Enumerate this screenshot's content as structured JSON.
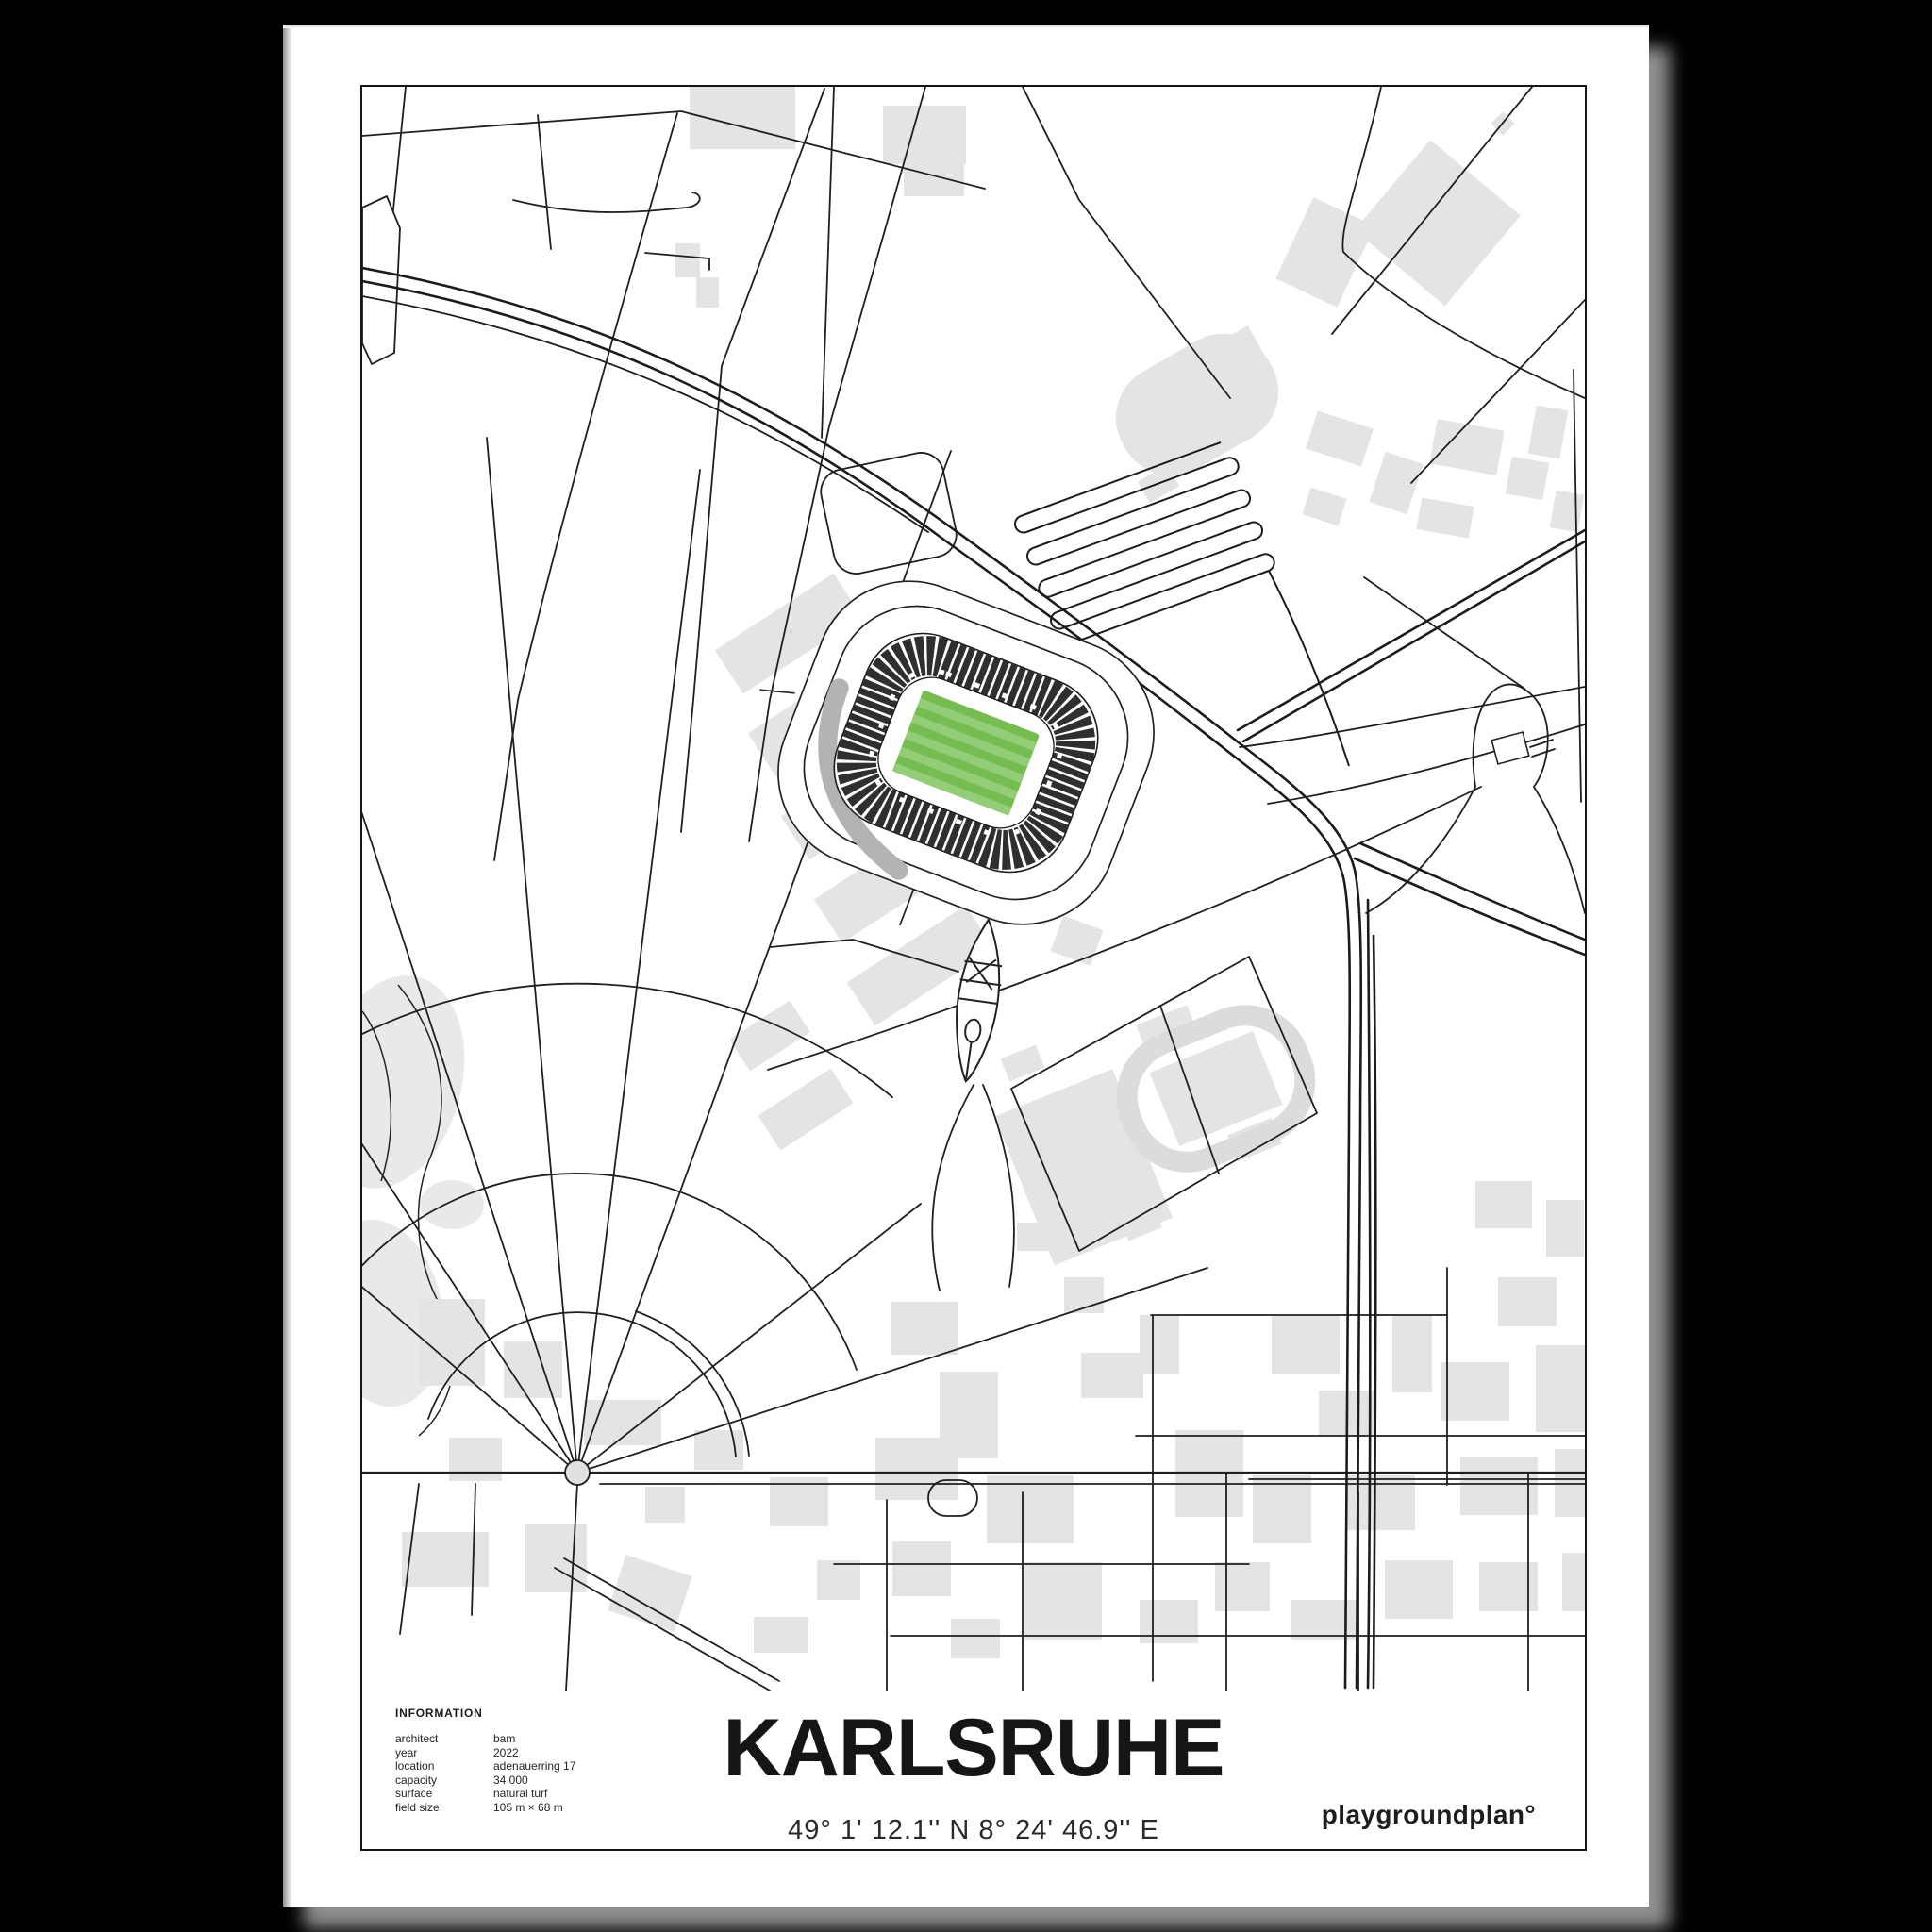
{
  "poster": {
    "title": "KARLSRUHE",
    "coordinates": "49° 1' 12.1'' N  8° 24' 46.9'' E",
    "brand": "playgroundplan°",
    "info": {
      "heading": "INFORMATION",
      "rows": [
        {
          "label": "architect",
          "value": "bam"
        },
        {
          "label": "year",
          "value": "2022"
        },
        {
          "label": "location",
          "value": "adenauerring 17"
        },
        {
          "label": "capacity",
          "value": "34 000"
        },
        {
          "label": "surface",
          "value": "natural turf"
        },
        {
          "label": "field size",
          "value": "105 m × 68 m"
        }
      ]
    }
  },
  "map": {
    "subject": "wildpark stadium footprint with surrounding street network of karlsruhe",
    "colors": {
      "background": "#ffffff",
      "road": "#1f1f1f",
      "building": "#e4e4e6",
      "park": "#e9e9ea",
      "frame": "#161616",
      "pitch_green": "#76bd51",
      "pitch_stripe": "#94cd77",
      "stand_dark": "#2f2f2f",
      "stand_building_gray": "#b3b3b3"
    }
  }
}
